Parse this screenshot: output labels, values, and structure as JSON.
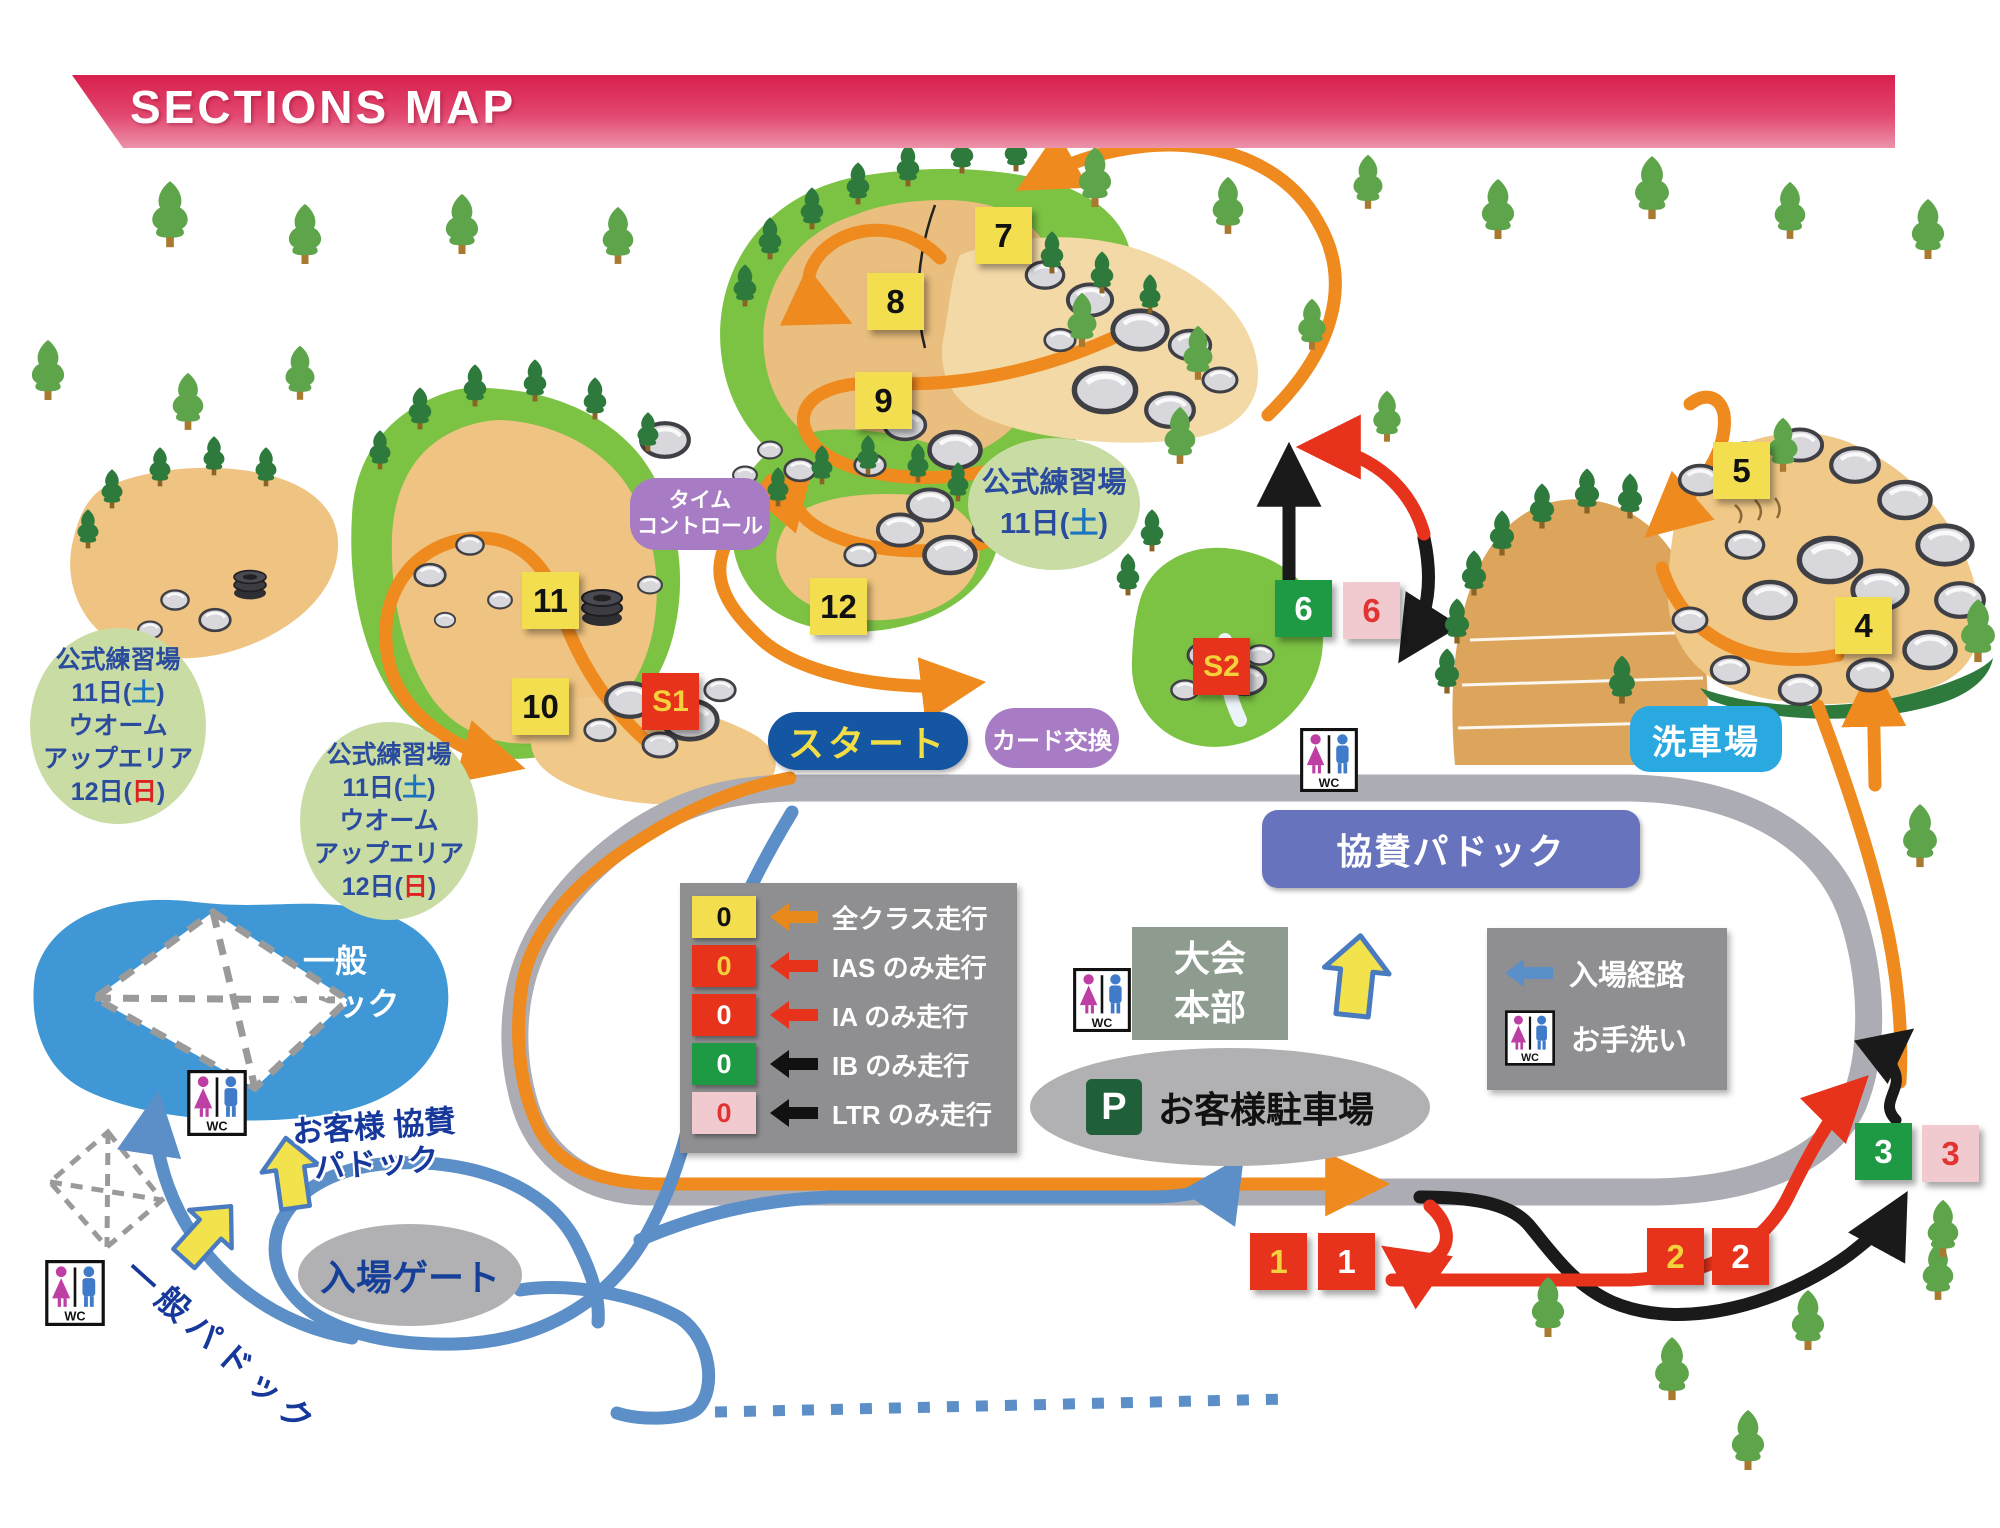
{
  "header": {
    "title": "SECTIONS MAP"
  },
  "areas": {
    "practice_top": {
      "line1": "公式練習場",
      "line2_pre": "11日(",
      "line2_day": "土",
      "line2_post": ")"
    },
    "practice_warmup": {
      "line1": "公式練習場",
      "line2_pre": "11日(",
      "line2_day": "土",
      "line2_post": ")",
      "line3": "ウオーム",
      "line4": "アップエリア",
      "line5_pre": "12日(",
      "line5_day": "日",
      "line5_post": ")"
    },
    "time_control_line1": "タイム",
    "time_control_line2": "コントロール",
    "start": "スタート",
    "card_exchange": "カード交換",
    "sponsor_paddock": "協賛パドック",
    "hq_line1": "大会",
    "hq_line2": "本部",
    "parking_mark": "P",
    "parking": "お客様駐車場",
    "wash": "洗車場",
    "entrance_gate": "入場ゲート",
    "lake_paddock_line1": "一般",
    "lake_paddock_line2": "パドック",
    "customer_sponsor_line1": "お客様 協賛",
    "customer_sponsor_line2": "パドック",
    "general_paddock": "一般パドック",
    "wc": "WC"
  },
  "legend": {
    "rows": [
      {
        "number": "0",
        "label": "全クラス走行"
      },
      {
        "number": "0",
        "label": "IAS のみ走行"
      },
      {
        "number": "0",
        "label": "IA のみ走行"
      },
      {
        "number": "0",
        "label": "IB のみ走行"
      },
      {
        "number": "0",
        "label": "LTR のみ走行"
      }
    ]
  },
  "legend_right": {
    "entry_route": "入場経路",
    "restroom": "お手洗い"
  },
  "markers": {
    "m1a": "1",
    "m1b": "1",
    "m2a": "2",
    "m2b": "2",
    "m3a": "3",
    "m3b": "3",
    "m4": "4",
    "m5": "5",
    "m6a": "6",
    "m6b": "6",
    "m7": "7",
    "m8": "8",
    "m9": "9",
    "m10": "10",
    "m11": "11",
    "m12": "12",
    "s1": "S1",
    "s2": "S2"
  },
  "colors": {
    "banner_pink": "#D91F4E",
    "road_gray": "#ACACB4",
    "route_orange": "#EE8A1E",
    "route_red": "#E8331C",
    "route_black": "#1A1A1A",
    "route_blue": "#5C8FC7",
    "all_class_yellow": "#F2DE4E",
    "ib_green": "#1E9A44",
    "ltr_pink": "#F0CACF"
  }
}
